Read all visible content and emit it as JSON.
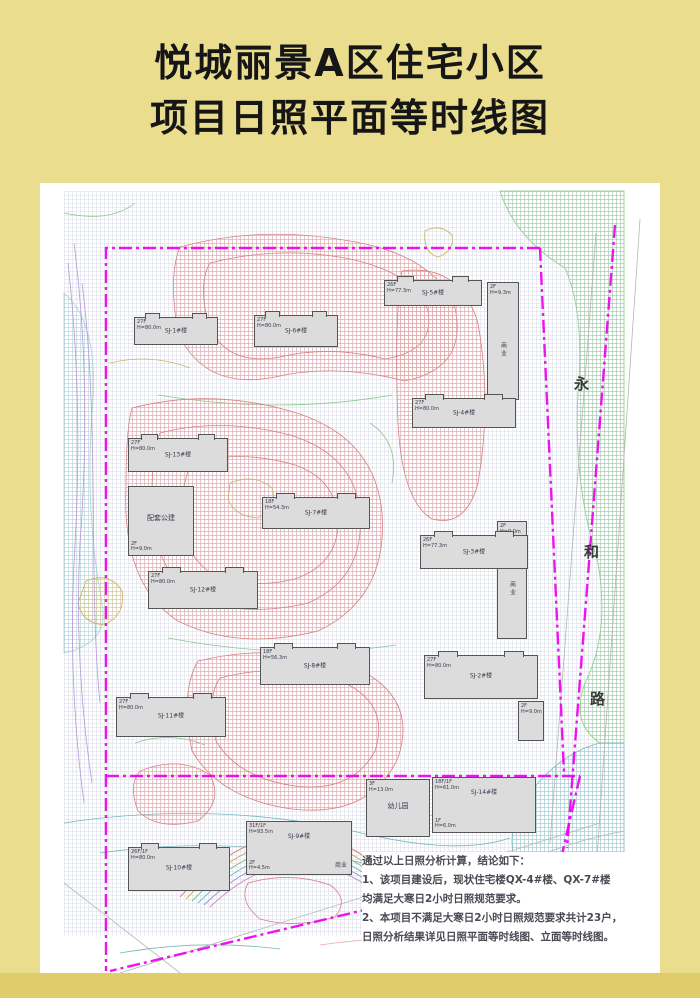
{
  "page": {
    "kind": "sunshine-isochrone-site-plan",
    "colors": {
      "paper": "#eadd8e",
      "panel": "#ffffff",
      "boundary_magenta": "#ee00ee",
      "building_fill": "#dcdcdc"
    }
  },
  "title": {
    "line1": "悦城丽景A区住宅小区",
    "line2": "项目日照平面等时线图"
  },
  "street": {
    "name": "永和路",
    "chars": [
      "永",
      "和",
      "路"
    ]
  },
  "buildings": [
    {
      "name": "SJ-1#楼",
      "spec": "27F\nH=80.0m"
    },
    {
      "name": "SJ-6#楼",
      "spec": "27F\nH=80.0m"
    },
    {
      "name": "SJ-5#楼",
      "spec": "26F\nH=77.3m"
    },
    {
      "name": "商业",
      "spec": "2F\nH=9.3m"
    },
    {
      "name": "SJ-4#楼",
      "spec": "27F\nH=80.0m"
    },
    {
      "name": "SJ-13#楼",
      "spec": "27F\nH=80.0m"
    },
    {
      "name": "配套公建",
      "spec": "2F\nH=9.0m"
    },
    {
      "name": "SJ-7#楼",
      "spec": "18F\nH=54.3m"
    },
    {
      "name": "SJ-3#楼",
      "spec": "26F\nH=77.3m"
    },
    {
      "name": "商业",
      "spec": "2F\nH=9.0m"
    },
    {
      "name": "SJ-12#楼",
      "spec": "27F\nH=80.0m"
    },
    {
      "name": "SJ-8#楼",
      "spec": "18F\nH=56.3m"
    },
    {
      "name": "SJ-2#楼",
      "spec": "27F\nH=80.0m"
    },
    {
      "name": "",
      "spec": "2F\nH=9.0m"
    },
    {
      "name": "SJ-11#楼",
      "spec": "27F\nH=80.0m"
    },
    {
      "name": "幼儿园",
      "spec": "3F\nH=13.0m"
    },
    {
      "name": "SJ-14#楼",
      "spec": "18F/1F\nH=61.0m",
      "extra": "1F\nH=6.0m"
    },
    {
      "name": "SJ-9#楼",
      "spec": "31F/1F\nH=93.5m",
      "extra": "2F\nH=4.5m",
      "sub": "商业"
    },
    {
      "name": "SJ-10#楼",
      "spec": "26F/1F\nH=80.0m"
    }
  ],
  "notes": {
    "lines": [
      "通过以上日照分析计算，结论如下：",
      "1、该项目建设后，现状住宅楼QX-4#楼、QX-7#楼",
      "均满足大寒日2小时日照规范要求。",
      "2、本项目不满足大寒日2小时日照规范要求共计23户，",
      "日照分析结果详见日照平面等时线图、立面等时线图。"
    ]
  }
}
